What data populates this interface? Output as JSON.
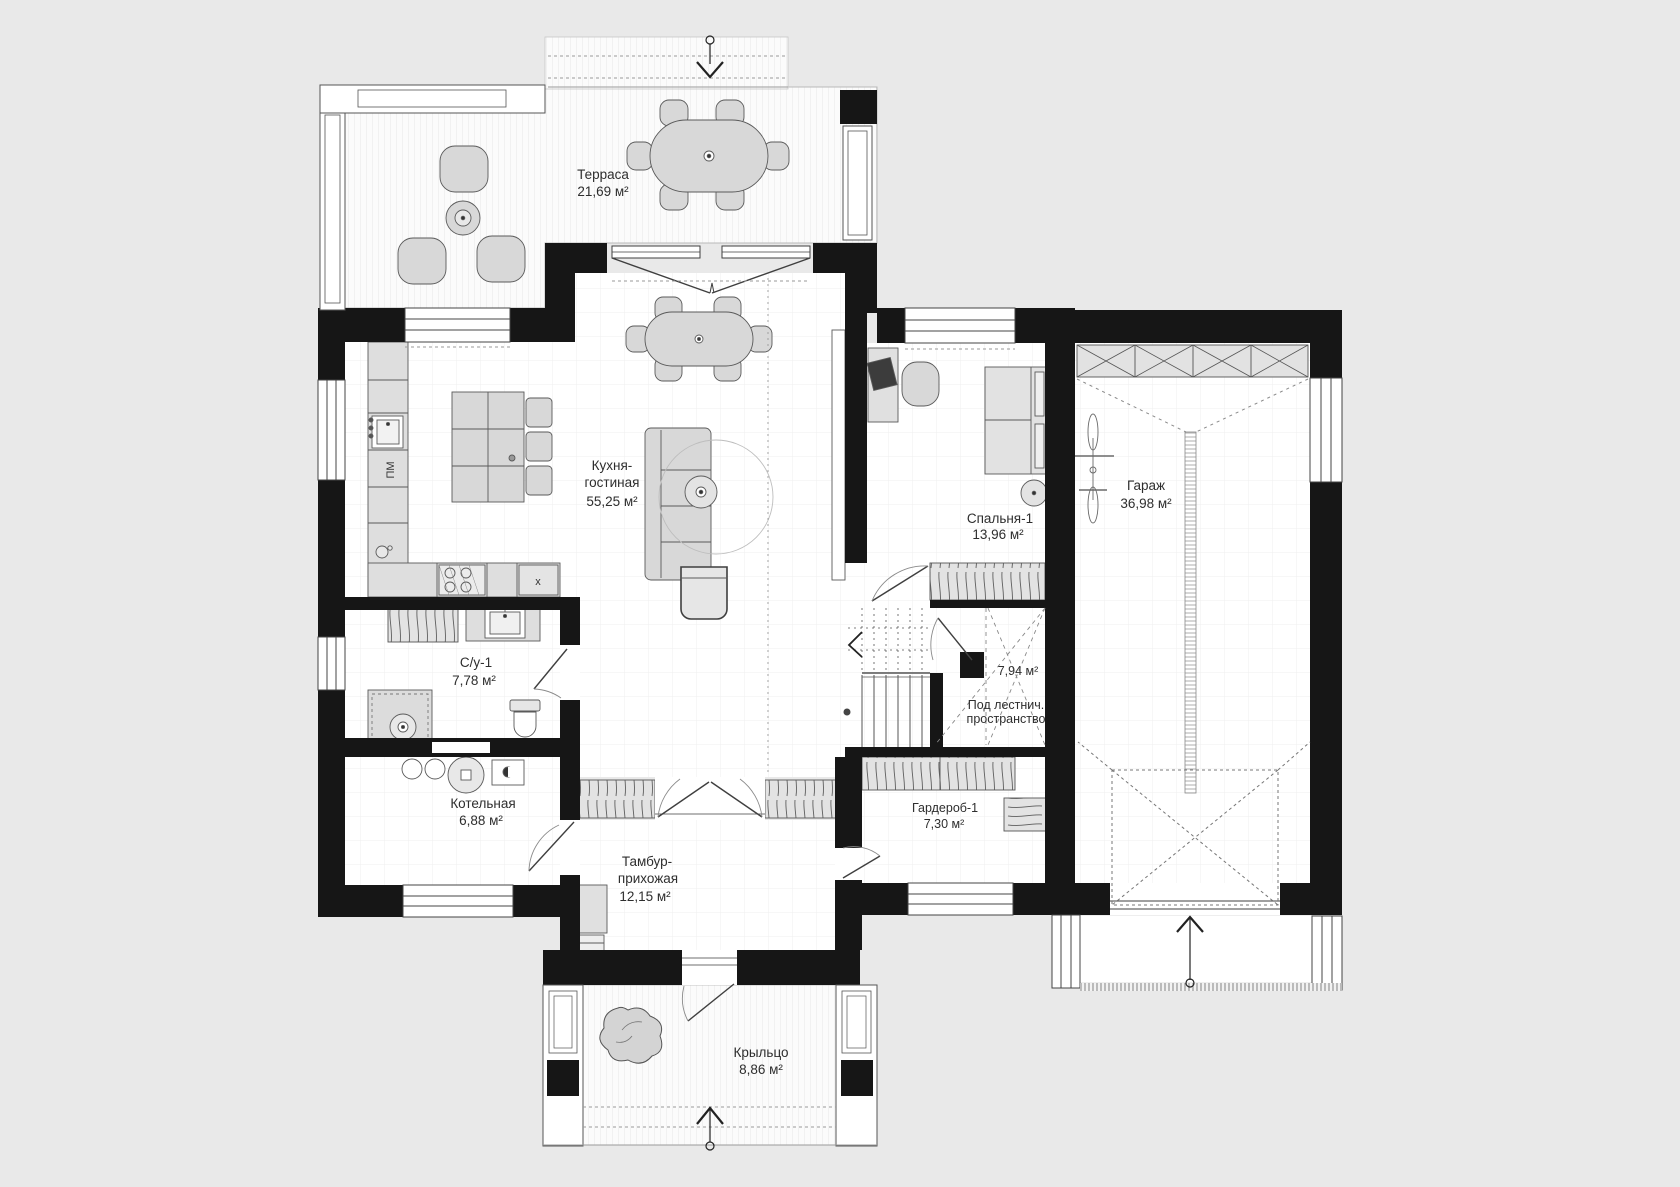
{
  "plan": {
    "colors": {
      "background": "#e9e9e9",
      "wall": "#161616",
      "furniture": "#d8d8d8",
      "floor": "#ffffff",
      "line": "#555555"
    },
    "rooms": [
      {
        "id": "terrace",
        "name": "Терраса",
        "area": "21,69 м²"
      },
      {
        "id": "kitchen",
        "name": "Кухня-",
        "name2": "гостиная",
        "area": "55,25 м²"
      },
      {
        "id": "bedroom1",
        "name": "Спальня-1",
        "area": "13,96 м²"
      },
      {
        "id": "garage",
        "name": "Гараж",
        "area": "36,98 м²"
      },
      {
        "id": "bathroom1",
        "name": "С/у-1",
        "area": "7,78 м²"
      },
      {
        "id": "boiler",
        "name": "Котельная",
        "area": "6,88 м²"
      },
      {
        "id": "vestibule",
        "name": "Тамбур-",
        "name2": "прихожая",
        "area": "12,15 м²"
      },
      {
        "id": "wardrobe1",
        "name": "Гардероб-1",
        "area": "7,30 м²"
      },
      {
        "id": "understairs",
        "name": "Под лестнич.",
        "name2": "пространство",
        "area": "7,94 м²"
      },
      {
        "id": "porch",
        "name": "Крыльцо",
        "area": "8,86 м²"
      }
    ],
    "markers": {
      "dishwasher": "ПМ",
      "stove": "x"
    }
  }
}
